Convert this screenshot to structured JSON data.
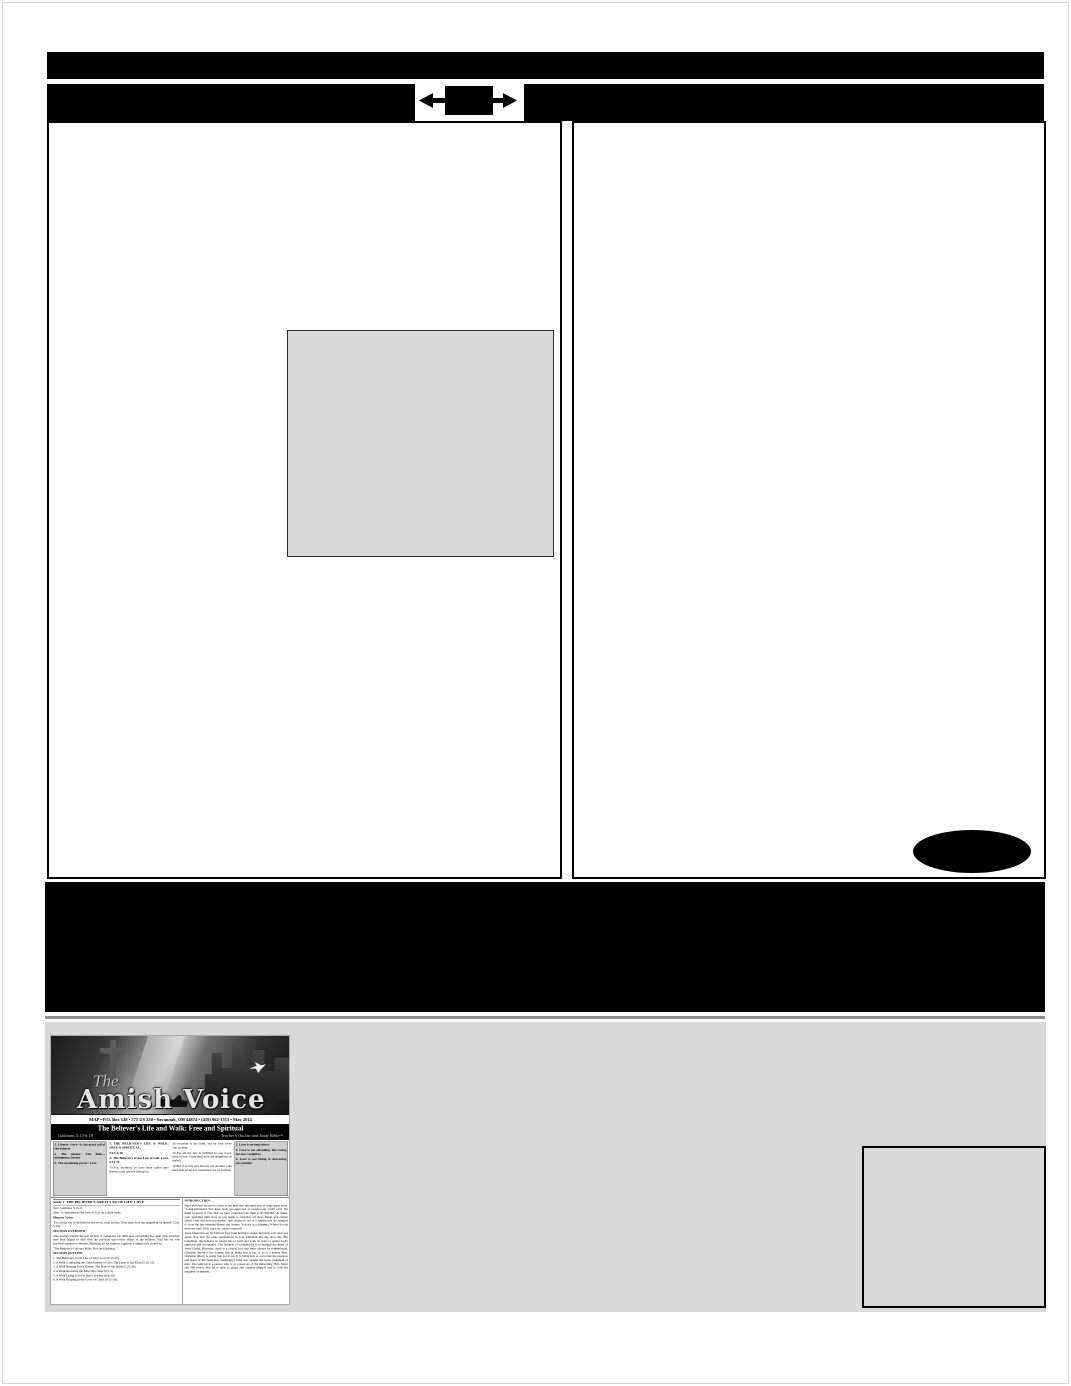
{
  "colors": {
    "redaction_black": "#000000",
    "panel_gray": "#d9d9d9",
    "band_gray": "#d9d9d9",
    "page_white": "#ffffff"
  },
  "icons": {
    "horizontal_arrows": "left-right expand arrows through black block"
  },
  "newsletter": {
    "masthead": {
      "the": "The",
      "logo": "Amish Voice",
      "info_line": "MAP  •  P.O. Box 128  •  575 US 250  •  Savannah, OH 44874  •  (419) 962-1515  •  May 2014"
    },
    "title_band": {
      "title": "The Believer's Life and Walk: Free and Spiritual",
      "scripture": "Galatians 5:13-6:18",
      "source": "– Teacher's Outline and Study Bible™"
    },
    "outline_left": {
      "item1": "1. Liberty—love—is the great call of the believer",
      "item1a": "a. The danger: The flesh—indulgence, license",
      "item1b": "b. The sustaining power: Love"
    },
    "col2": {
      "heading1": "5. THE BELIEVER'S LIFE & WALK: FREE & SPIRITUAL,",
      "ref1": "5:13–6:18",
      "heading2": "A. The Believer's Great Law of Life: Love, 5:13-15",
      "verse13": "13 For, brethren, ye have been called unto liberty; only use not liberty for"
    },
    "col3": {
      "verse13b": "an occasion to the flesh, but by love serve one another.",
      "verse14": "14 For all the law is fulfilled in one word, even in this; Thou shalt love thy neighbour as thyself.",
      "verse15": "15 But if ye bite and devour one another, take heed that ye be not consumed one of another."
    },
    "outline_right": {
      "item2": "2. Love is serving others",
      "item3": "3. Love is not offending, but caring for one's neighbor",
      "item4": "4. Love is not biting & devouring one another"
    },
    "study": {
      "title": "Study 1: THE BELIEVER'S GREAT LAW OF LIFE: LOVE",
      "text_line": "Text: Galatians 5:13-15",
      "aim_line": "Aim: To demonstrate the love of God on a daily basis.",
      "memory_label": "Memory Verse:",
      "memory_verse": "\"For all the law is fulfilled in one word, even in this; Thou shalt love thy neighbour as thyself\" (Gal. 5:14).",
      "overview_label": "SECTION OVERVIEW:",
      "overview_text": "This passage begins the last section of Galatians. Up until now everything has dealt with doctrine; now Paul begins to deal with the practical day-to-day affairs of the believer. Paul has six vast practical subjects to discuss. Blending all six subjects together, a simple title would be:",
      "overview_quote": "\"The Believer's Life and Walk: Free and Spiritual.\"",
      "outline_label": "SECTION OUTLINE:",
      "outline": [
        "1. The Believer's Great Law of Life: Love (5:13-15).",
        "2. A Walk Combating the Great Enemy of Life: The Lusts of the Flesh (5:16-21).",
        "3. A Walk Bearing God's Nature: The Fruit of the Spirit (5:22-26).",
        "4. A Walk Restoring the Man Who Slips (6:1-5).",
        "5. A Walk Doing Good to One's Teacher (6:6-10).",
        "6. A Walk Reaping in the Cross of Christ (6:11-18)."
      ]
    },
    "intro": {
      "label": "INTRODUCTION:",
      "p1": "Have you ever received a letter in the mail that informed you of some great news. \"Congratulations! You have been pre-approved to receive our credit card. We think so much of you, that we have extended your limit to $7,500.00!\" At times, your spending limit rises as you begin to visualize all those things you cannot afford—but that does not matter—just charge it! All of a sudden you are tempted to cross the line between liberty and license. You are in a dilemma. Where do you draw the line? How can you control yourself?",
      "p2": "Jesus Christ has set the believer free from having to make decisions over and over again. You face the same temptations in your Christian life day after day. But remember, the believer no longer has to yield and work in order to secure God's approval and acceptance. The believer is accepted by God through the merit of Jesus Christ. However, there is a critical fact that must always be remembered: Christian liberty is not license, that is, being free to sin, to do as a person likes. Christian liberty is being free not to sin. It is being free to overcome the passions and urges of the flesh that (seemingly) wage war against the better judgment of man. The believer is a person who is so conscious of the indwelling Holy Spirit and His power that he is able to purge and cleanse himself and to love his neighbor as himself."
    }
  }
}
